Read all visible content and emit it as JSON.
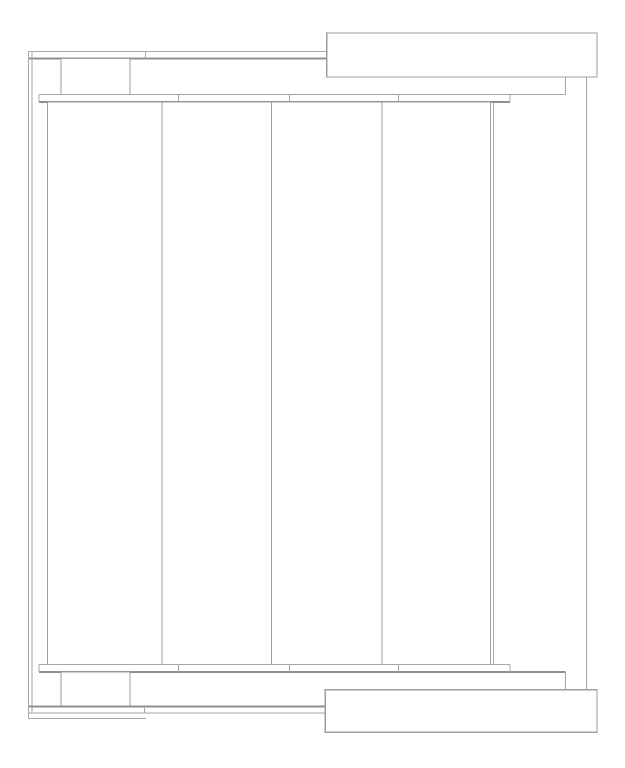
{
  "meta": {
    "title": "Technical plan drawing",
    "description": "CAD-style plan view line drawing of a panel awning structure with rails, tracks, brackets and cassette boxes",
    "text_content": "none"
  },
  "canvas": {
    "width": 625,
    "height": 768,
    "background": "#ffffff"
  },
  "colors": {
    "line": "#a6a6a6",
    "line_dark": "#8f8f8f",
    "box_stroke": "#9e9e9e",
    "fill": "#ffffff"
  },
  "structure": {
    "panel_count": 4,
    "seam_positions_x": [
      178.3,
      289.3,
      398.6
    ],
    "panel_edges_x": [
      47.3,
      162,
      271.5,
      382,
      490.3
    ],
    "track_span_x": [
      39,
      510
    ],
    "panel_span_y": [
      101.8,
      664.7
    ]
  },
  "shapes": [
    {
      "name": "top-strip-upper-line",
      "type": "line",
      "x1": 28.3,
      "y1": 51.7,
      "x2": 326.7,
      "y2": 51.7,
      "w": 1
    },
    {
      "name": "top-strip-lower-line",
      "type": "line",
      "x1": 28.3,
      "y1": 58.3,
      "x2": 326.7,
      "y2": 58.3,
      "w": 2
    },
    {
      "name": "top-strip-splice-tick",
      "type": "line",
      "x1": 145.7,
      "y1": 51.7,
      "x2": 145.7,
      "y2": 58.3,
      "w": 1
    },
    {
      "name": "left-rail-outer-line",
      "type": "line",
      "x1": 28.3,
      "y1": 51.7,
      "x2": 28.3,
      "y2": 718.6,
      "w": 1
    },
    {
      "name": "left-rail-inner-line",
      "type": "line",
      "x1": 32,
      "y1": 51.7,
      "x2": 32,
      "y2": 713,
      "w": 1
    },
    {
      "name": "top-left-bracket-box",
      "type": "rect",
      "x": 61,
      "y": 58.3,
      "width": 69,
      "height": 36.3,
      "w": 1
    },
    {
      "name": "top-track-top-line",
      "type": "line",
      "x1": 39,
      "y1": 94.6,
      "x2": 565.7,
      "y2": 94.6,
      "w": 1
    },
    {
      "name": "top-track-connector",
      "type": "line",
      "x1": 565.7,
      "y1": 77,
      "x2": 565.7,
      "y2": 94.6,
      "w": 1
    },
    {
      "name": "top-track-bottom-line",
      "type": "line",
      "x1": 39,
      "y1": 101.8,
      "x2": 510,
      "y2": 101.8,
      "w": 2
    },
    {
      "name": "top-track-left-cap",
      "type": "line",
      "x1": 39,
      "y1": 94.6,
      "x2": 39,
      "y2": 101.8,
      "w": 1
    },
    {
      "name": "top-track-right-cap",
      "type": "line",
      "x1": 510,
      "y1": 94.6,
      "x2": 510,
      "y2": 101.8,
      "w": 1
    },
    {
      "name": "top-track-seam-1",
      "type": "line",
      "x1": 178.3,
      "y1": 94.6,
      "x2": 178.3,
      "y2": 101.8,
      "w": 1
    },
    {
      "name": "top-track-seam-2",
      "type": "line",
      "x1": 289.3,
      "y1": 94.6,
      "x2": 289.3,
      "y2": 101.8,
      "w": 1
    },
    {
      "name": "top-track-seam-3",
      "type": "line",
      "x1": 398.6,
      "y1": 94.6,
      "x2": 398.6,
      "y2": 101.8,
      "w": 1
    },
    {
      "name": "panel-1",
      "type": "rect",
      "x": 47.3,
      "y": 101.8,
      "width": 114.7,
      "height": 562.9,
      "w": 1
    },
    {
      "name": "panel-2",
      "type": "rect",
      "x": 162,
      "y": 101.8,
      "width": 109.5,
      "height": 562.9,
      "w": 1
    },
    {
      "name": "panel-3",
      "type": "rect",
      "x": 271.5,
      "y": 101.8,
      "width": 110.5,
      "height": 562.9,
      "w": 1
    },
    {
      "name": "panel-4",
      "type": "rect",
      "x": 382,
      "y": 101.8,
      "width": 108.3,
      "height": 562.9,
      "w": 1
    },
    {
      "name": "panel-right-guide-line",
      "type": "line",
      "x1": 493.3,
      "y1": 101.8,
      "x2": 493.3,
      "y2": 664.7,
      "w": 1
    },
    {
      "name": "right-rail-line",
      "type": "line",
      "x1": 586.7,
      "y1": 77,
      "x2": 586.7,
      "y2": 689.7,
      "w": 1
    },
    {
      "name": "bottom-track-top-line",
      "type": "line",
      "x1": 39,
      "y1": 664.7,
      "x2": 510,
      "y2": 664.7,
      "w": 1
    },
    {
      "name": "bottom-track-bottom-line",
      "type": "line",
      "x1": 39,
      "y1": 671.8,
      "x2": 565.7,
      "y2": 671.8,
      "w": 2
    },
    {
      "name": "bottom-track-connector",
      "type": "line",
      "x1": 565.7,
      "y1": 671.8,
      "x2": 565.7,
      "y2": 689.7,
      "w": 1
    },
    {
      "name": "bottom-track-left-cap",
      "type": "line",
      "x1": 39,
      "y1": 664.7,
      "x2": 39,
      "y2": 671.8,
      "w": 1
    },
    {
      "name": "bottom-track-right-cap",
      "type": "line",
      "x1": 510,
      "y1": 664.7,
      "x2": 510,
      "y2": 671.8,
      "w": 1
    },
    {
      "name": "bottom-track-seam-1",
      "type": "line",
      "x1": 178.3,
      "y1": 664.7,
      "x2": 178.3,
      "y2": 671.8,
      "w": 1
    },
    {
      "name": "bottom-track-seam-2",
      "type": "line",
      "x1": 289.3,
      "y1": 664.7,
      "x2": 289.3,
      "y2": 671.8,
      "w": 1
    },
    {
      "name": "bottom-track-seam-3",
      "type": "line",
      "x1": 398.6,
      "y1": 664.7,
      "x2": 398.6,
      "y2": 671.8,
      "w": 1
    },
    {
      "name": "bottom-left-bracket-box",
      "type": "rect",
      "x": 61,
      "y": 671.8,
      "width": 69,
      "height": 34.5,
      "w": 1
    },
    {
      "name": "bottom-strip-upper-line",
      "type": "line",
      "x1": 28.3,
      "y1": 706.3,
      "x2": 326,
      "y2": 706.3,
      "w": 2
    },
    {
      "name": "bottom-strip-lower-line",
      "type": "line",
      "x1": 28.3,
      "y1": 713,
      "x2": 326,
      "y2": 713,
      "w": 1
    },
    {
      "name": "bottom-strip-splice-tick",
      "type": "line",
      "x1": 144.7,
      "y1": 706.3,
      "x2": 144.7,
      "y2": 713,
      "w": 1
    },
    {
      "name": "bottom-closure-line",
      "type": "line",
      "x1": 28.3,
      "y1": 718.6,
      "x2": 146,
      "y2": 718.6,
      "w": 1
    },
    {
      "name": "top-cassette-box",
      "type": "rect",
      "x": 326.7,
      "y": 33,
      "width": 270.3,
      "height": 44,
      "w": 1.2
    },
    {
      "name": "bottom-cassette-box",
      "type": "rect",
      "x": 325.3,
      "y": 689.7,
      "width": 271.7,
      "height": 42.6,
      "w": 1.2
    }
  ]
}
